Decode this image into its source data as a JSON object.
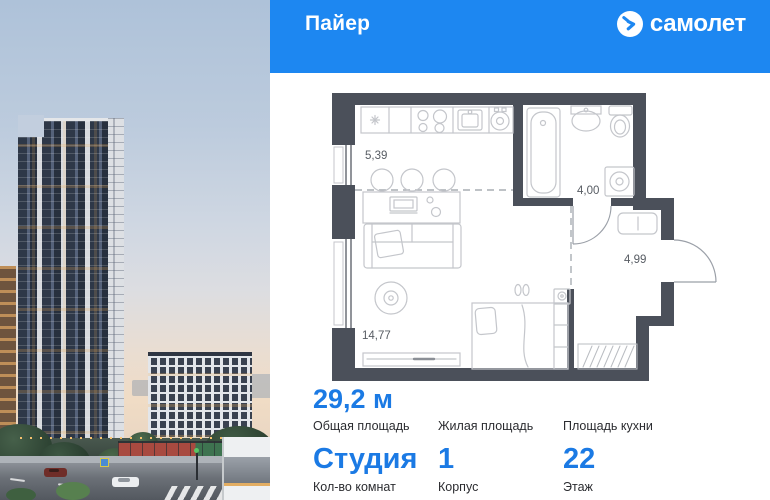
{
  "header": {
    "project_title": "Пайер",
    "brand_name": "самолет"
  },
  "floor_plan": {
    "rooms": [
      {
        "id": "kitchen",
        "area": "5,39"
      },
      {
        "id": "bathroom",
        "area": "4,00"
      },
      {
        "id": "hallway",
        "area": "4,99"
      },
      {
        "id": "living_room",
        "area": "14,77"
      }
    ]
  },
  "stats": {
    "row1": [
      {
        "value": "29,2 м",
        "label": "Общая площадь"
      },
      {
        "value": "",
        "label": "Жилая площадь"
      },
      {
        "value": "",
        "label": "Площадь кухни"
      }
    ],
    "row2": [
      {
        "value": "Студия",
        "label": "Кол-во комнат"
      },
      {
        "value": "1",
        "label": "Корпус"
      },
      {
        "value": "22",
        "label": "Этаж"
      }
    ]
  },
  "colors": {
    "brand_blue": "#1d87f1",
    "value_blue": "#1b7ae4",
    "plan_wall": "#4b505a"
  }
}
